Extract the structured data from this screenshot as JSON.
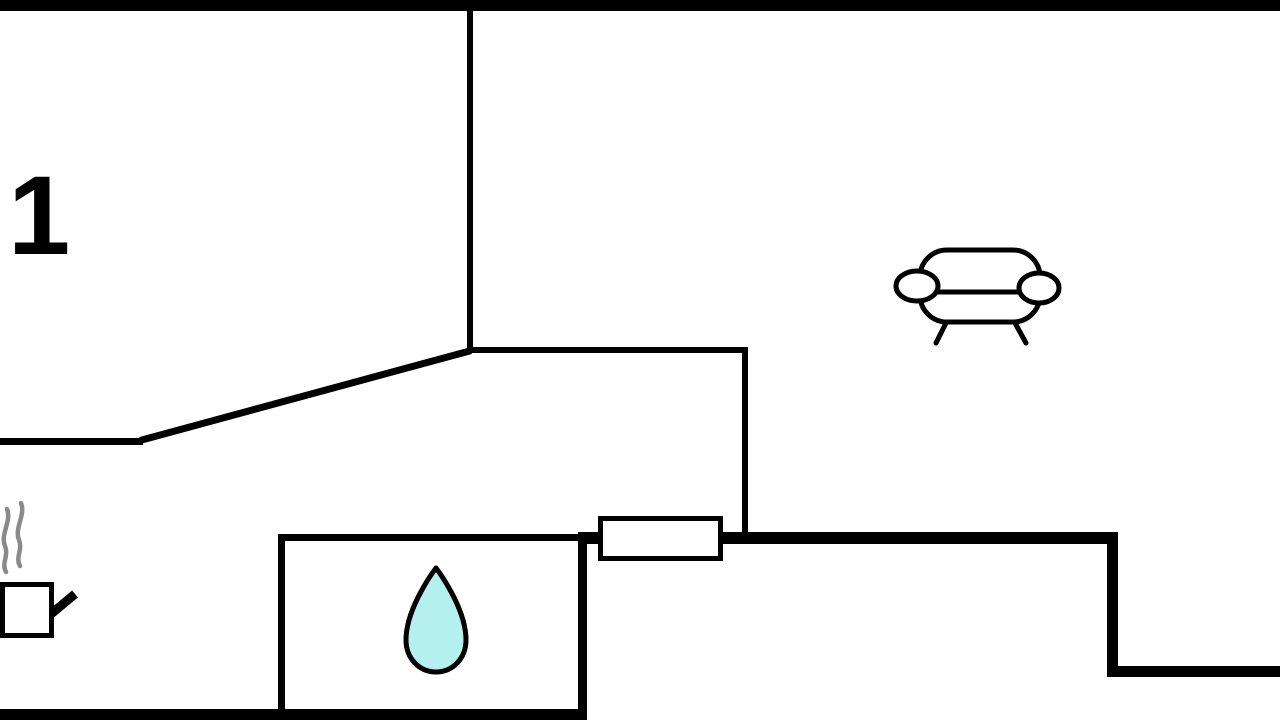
{
  "floorplan": {
    "room_label": "1",
    "colors": {
      "wall": "#000000",
      "background": "#ffffff",
      "water_drop_fill": "#b4f1ee",
      "steam_gray": "#8a8a8a"
    },
    "icons": {
      "sofa": "sofa-icon",
      "water_drop": "water-drop-icon",
      "cooking_pot": "steaming-pot-icon"
    }
  }
}
